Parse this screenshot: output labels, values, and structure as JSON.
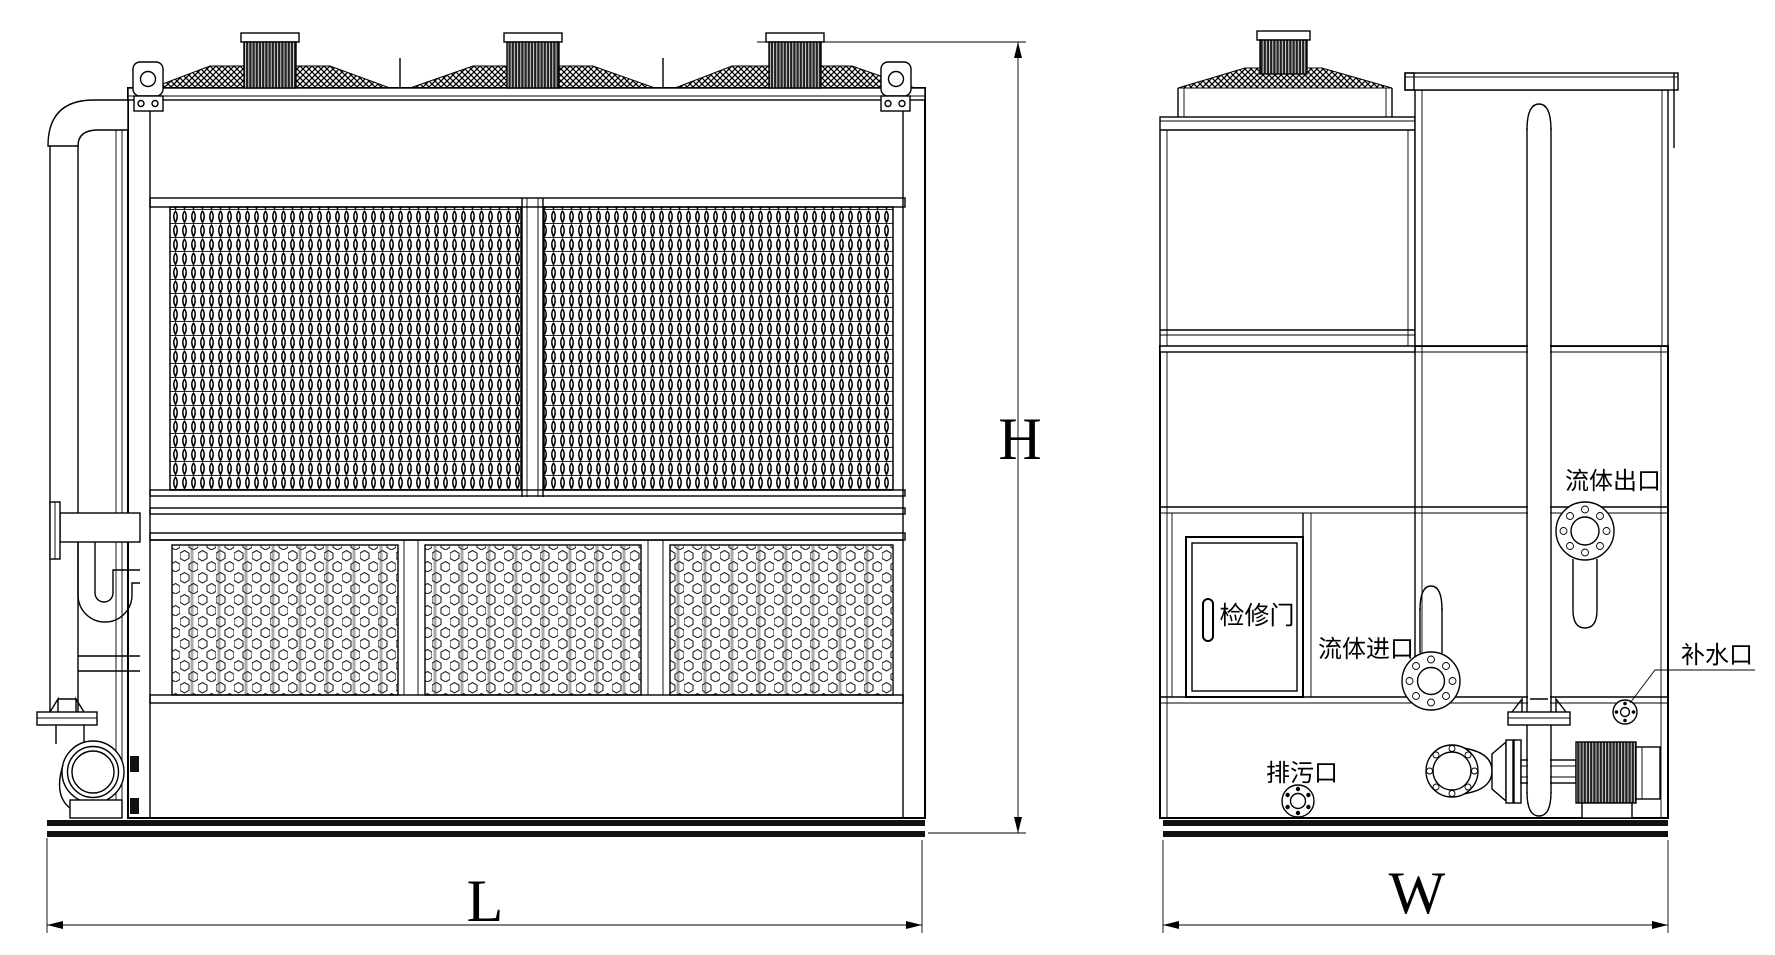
{
  "drawing_labels": {
    "dim_length": "L",
    "dim_height": "H",
    "dim_width": "W",
    "access_door": "检修门",
    "fluid_outlet": "流体出口",
    "fluid_inlet": "流体进口",
    "makeup_water_port": "补水口",
    "drain_port": "排污口"
  },
  "colors": {
    "line": "#000000",
    "background": "#ffffff",
    "dark_fill": "#111111"
  }
}
